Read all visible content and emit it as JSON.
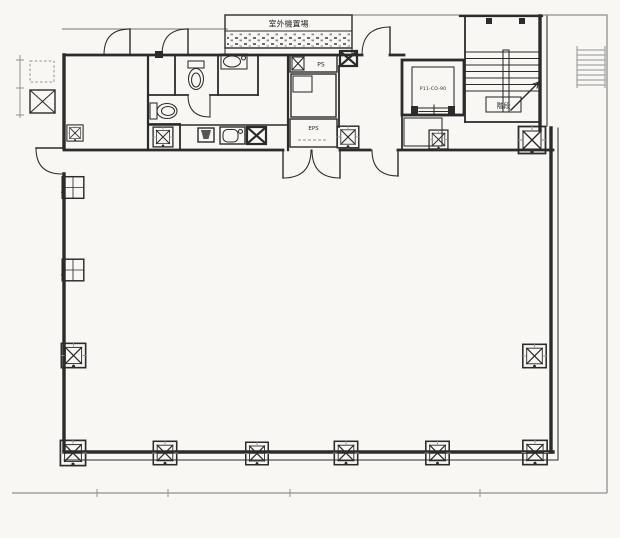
{
  "labels": {
    "outdoor_unit_area": "室外機置場",
    "pipe_shaft": "PS",
    "electric_pipe_shaft": "EPS",
    "elevator": "P11-CO-90",
    "stairs": "階段"
  },
  "colors": {
    "background": "#f8f7f4",
    "ink": "#2b2b2b",
    "ink_light": "#909090"
  }
}
